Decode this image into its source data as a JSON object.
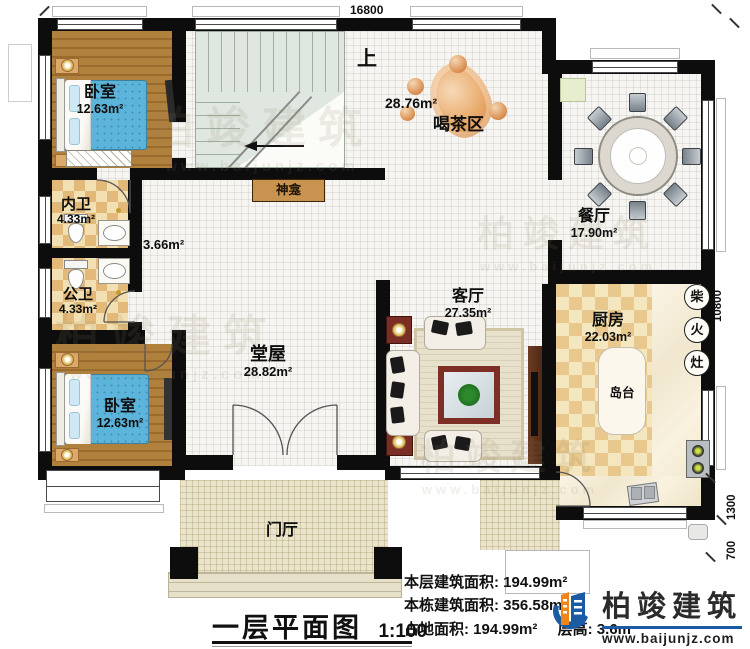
{
  "dimensions": {
    "top": "16800",
    "right_main": "10800",
    "right_mid": "1300",
    "right_low": "700"
  },
  "rooms": {
    "bedroom_tl": {
      "name": "卧室",
      "area": "12.63m²"
    },
    "ensuite": {
      "name": "内卫",
      "area": "4.33m²"
    },
    "public_bath": {
      "name": "公卫",
      "area": "4.33m²"
    },
    "hall_area": "3.66m²",
    "bedroom_bl": {
      "name": "卧室",
      "area": "12.63m²"
    },
    "tangwu": {
      "name": "堂屋",
      "area": "28.82m²"
    },
    "tea": {
      "name": "喝茶区",
      "area": "28.76m²"
    },
    "stairs_up": "上",
    "shrine": "神龛",
    "dining": {
      "name": "餐厅",
      "area": "17.90m²"
    },
    "living": {
      "name": "客厅",
      "area": "27.35m²"
    },
    "kitchen": {
      "name": "厨房",
      "area": "22.03m²"
    },
    "island": "岛台",
    "firewood": [
      "柴",
      "火",
      "灶"
    ],
    "foyer": "门厅"
  },
  "titleblock": {
    "title": "一层平面图",
    "scale": "1:100"
  },
  "stats": {
    "l1": {
      "label": "本层建筑面积: ",
      "value": "194.99m²"
    },
    "l2": {
      "label": "本栋建筑面积: ",
      "value": "356.58m²"
    },
    "l3": {
      "label": "占地面积: ",
      "value": "194.99m²"
    },
    "l4": {
      "label": "层高: ",
      "value": "3.6m"
    }
  },
  "logo": {
    "name": "柏竣建筑",
    "url": "www.baijunjz.com"
  },
  "watermark": {
    "text": "柏竣建筑",
    "url": "www.baijunjz.com"
  },
  "colors": {
    "wall": "#0d0d0d",
    "wood": "#a87534",
    "tile": "#e8c88c",
    "logo_blue": "#1a5ba4",
    "logo_orange": "#f08519",
    "shrine": "#c8934e"
  }
}
